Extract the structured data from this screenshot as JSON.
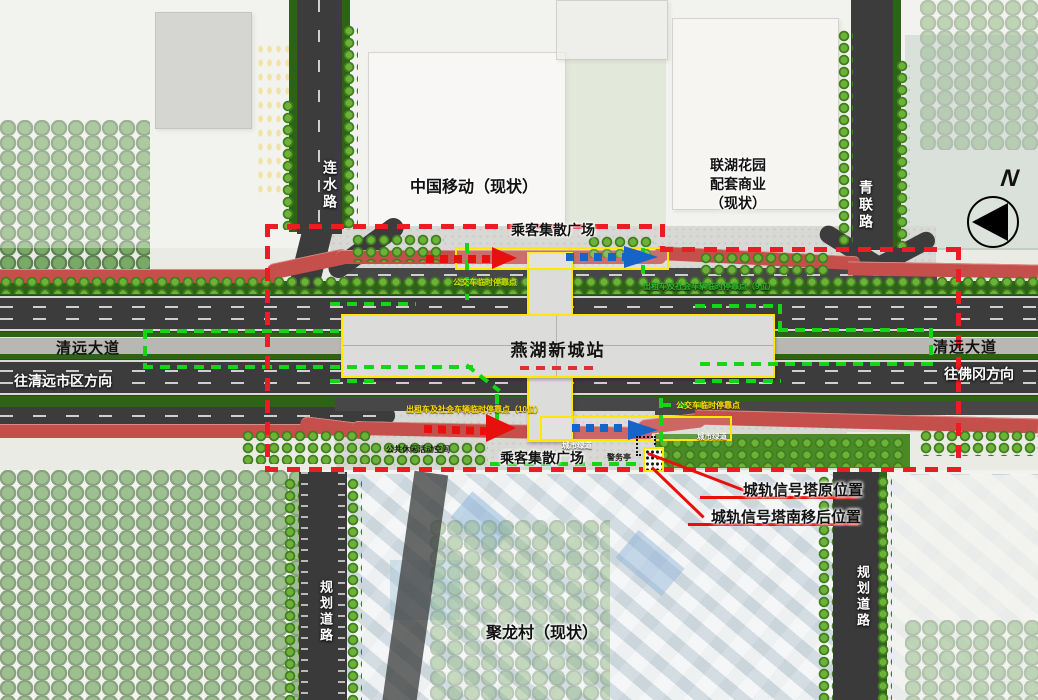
{
  "map": {
    "station_name": "燕湖新城站",
    "plaza_top": "乘客集散广场",
    "plaza_bottom": "乘客集散广场",
    "buildings": {
      "china_mobile": "中国移动（现状）",
      "lianhu_commercial": "联湖花园\n配套商业\n（现状）",
      "julong_village": "聚龙村（现状）"
    },
    "roads": {
      "lianshui_road": "连水路",
      "qinglian_road": "青联路",
      "qingyuan_avenue_west": "清远大道",
      "qingyuan_avenue_east": "清远大道",
      "dir_to_qingyuan_city": "往清远市区方向",
      "dir_to_fogang": "往佛冈方向",
      "planned_road_sw": "规划道路",
      "planned_road_se": "规划道路"
    },
    "stops": {
      "bus_temp_stop_north": "公交车临时停靠点",
      "taxi_social_stop_north": "出租车及社会车辆临时停靠点（9位）",
      "taxi_social_stop_south": "出租车及社会车辆临时停靠点（10位）",
      "bus_temp_stop_south": "公交车临时停靠点"
    },
    "features": {
      "urban_greenway_a": "城市绿道",
      "urban_greenway_b": "城市绿道",
      "police_kiosk": "警务亭",
      "public_leisure_space": "公共休闲活动空间"
    },
    "callouts": {
      "signal_tower_original": "城轨信号塔原位置",
      "signal_tower_relocated": "城轨信号塔南移后位置"
    },
    "compass_n": "N",
    "colors": {
      "boundary_red": "#ec1c24",
      "route_green": "#14d614",
      "outline_yellow": "#ffe800",
      "arrow_blue": "#1565c8",
      "arrow_red": "#e8100d",
      "greenway_path": "#c44f4b",
      "road_gray": "#3c3c3c",
      "verge_green": "#2c6317"
    }
  }
}
